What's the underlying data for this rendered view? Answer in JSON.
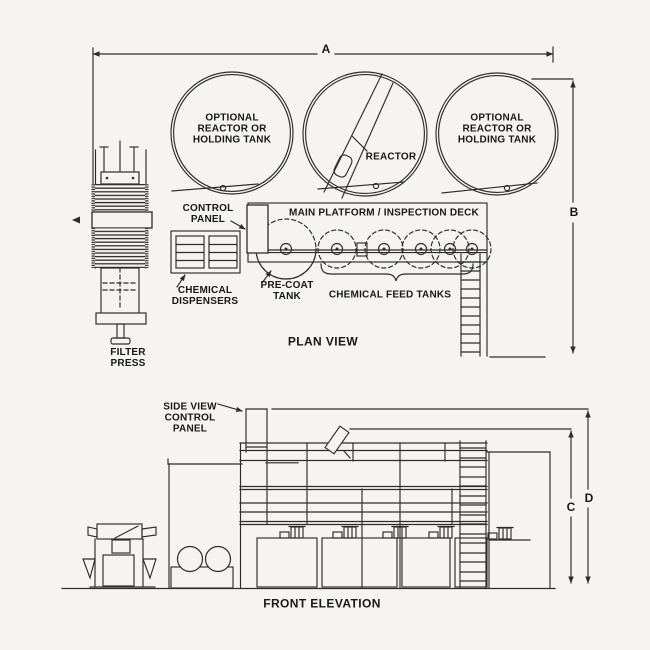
{
  "colors": {
    "paper": "#f5f4f1",
    "ink": "#2e2c28",
    "text": "#1a1814"
  },
  "plan_view": {
    "title": "PLAN VIEW",
    "dim_a": "A",
    "dim_b": "B",
    "tank_left_label": "OPTIONAL\nREACTOR OR\nHOLDING TANK",
    "reactor_label": "REACTOR",
    "tank_right_label": "OPTIONAL\nREACTOR OR\nHOLDING TANK",
    "control_panel_label": "CONTROL\nPANEL",
    "platform_label": "MAIN PLATFORM / INSPECTION DECK",
    "chemical_dispensers_label": "CHEMICAL\nDISPENSERS",
    "pre_coat_label": "PRE-COAT\nTANK",
    "feed_tanks_label": "CHEMICAL FEED TANKS",
    "filter_press_label": "FILTER\nPRESS"
  },
  "front_elevation": {
    "title": "FRONT ELEVATION",
    "dim_c": "C",
    "dim_d": "D",
    "control_panel_label": "SIDE VIEW\nCONTROL\nPANEL"
  }
}
